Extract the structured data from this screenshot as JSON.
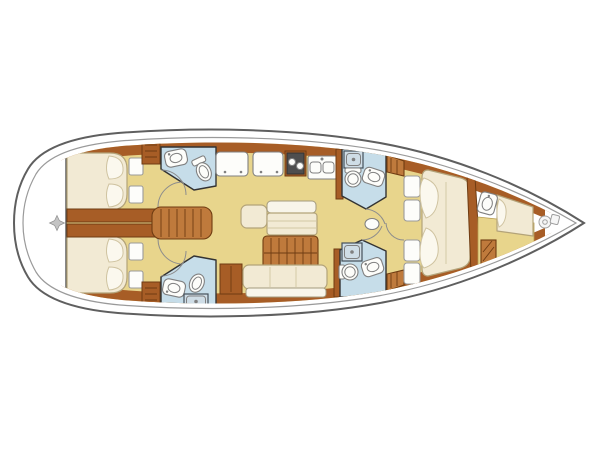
{
  "page": {
    "background": "#ffffff"
  },
  "diagram": {
    "kind": "sailing-yacht-interior-deck-plan",
    "orientation": "bow-right-stern-left",
    "rooms": [
      {
        "name": "transom-swim-platform",
        "features": [
          "helm-compass-mark"
        ]
      },
      {
        "name": "aft-cabin-port",
        "features": [
          "double-berth",
          "pillows",
          "storage-hatches"
        ]
      },
      {
        "name": "aft-cabin-starboard",
        "features": [
          "double-berth",
          "pillows",
          "storage-hatches"
        ]
      },
      {
        "name": "aft-head-port",
        "features": [
          "vanity-sink",
          "toilet",
          "cabinet"
        ]
      },
      {
        "name": "aft-head-starboard",
        "features": [
          "vanity-sink",
          "toilet",
          "shower-pan",
          "cabinet"
        ]
      },
      {
        "name": "companionway",
        "features": [
          "steps",
          "engine-box",
          "doors"
        ]
      },
      {
        "name": "galley",
        "features": [
          "worktop",
          "worktop",
          "two-burner-stove",
          "double-sink"
        ]
      },
      {
        "name": "saloon",
        "features": [
          "side-seat",
          "port-settee",
          "dining-table",
          "starboard-settee",
          "cabinet"
        ]
      },
      {
        "name": "forward-head-port",
        "features": [
          "shower-pan",
          "toilet",
          "vanity-sink"
        ]
      },
      {
        "name": "forward-head-starboard",
        "features": [
          "shower-pan",
          "toilet",
          "vanity-sink",
          "louver-cabinet"
        ]
      },
      {
        "name": "owner-cabin",
        "features": [
          "island-double-berth",
          "pillows",
          "wardrobe-lockers",
          "corridor-stool"
        ]
      },
      {
        "name": "crew-cabin",
        "features": [
          "berth",
          "sink",
          "step",
          "floor"
        ]
      },
      {
        "name": "anchor-locker",
        "features": [
          "windlass"
        ]
      }
    ]
  },
  "colors": {
    "background": "#ffffff",
    "hull_line": "#5f5f5f",
    "hull_inner_line": "#9a9a9a",
    "floor": "#e8d58c",
    "wood": "#a75d26",
    "wood_light": "#bf7a3c",
    "wood_dark": "#6f3c12",
    "bed": "#f2ead4",
    "bed_line": "#b3a379",
    "pillow": "#fbf8ee",
    "pillow_line": "#cfc3a0",
    "bath": "#c6dde9",
    "bath_line": "#333333",
    "fixture": "#fdfdfa",
    "fixture_line": "#808080",
    "shower": "#cfdde6",
    "stove": "#4e4e4e",
    "steel": "#a0a0a0",
    "crease": "#d9cfae"
  }
}
